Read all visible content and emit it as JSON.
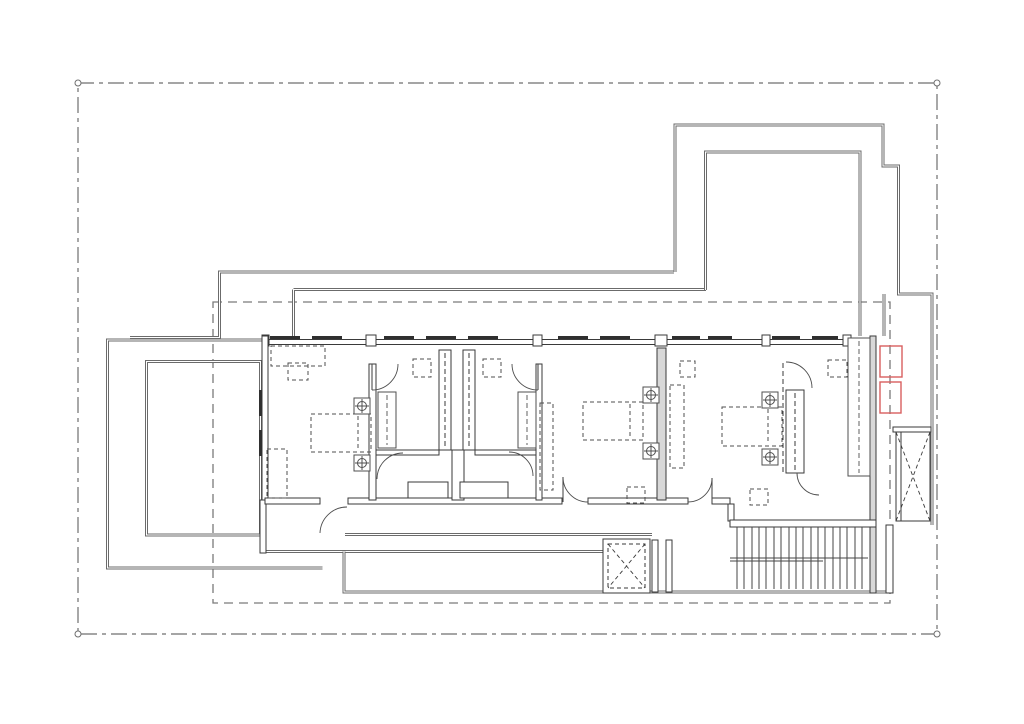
{
  "page": {
    "title": "Architectural floor plan drawing",
    "background": "#ffffff"
  },
  "colors": {
    "paper": "#ffffff",
    "boundary_line": "#6f6f6f",
    "setback_line": "#7a7a7a",
    "roof_line": "#6b6b6b",
    "wall_line": "#3a3a3a",
    "detail_line": "#4d4d4d",
    "furniture_line": "#4f4f4f",
    "stair_line": "#454545",
    "highlight_red": "#d95f5f",
    "wall_fill": "#ffffff",
    "poche_fill": "#d8d8d8",
    "tick_fill": "#2f2f2f"
  },
  "drawing": {
    "type": "architectural floor plan",
    "elements": [
      "property boundary with corner markers",
      "dashed setback outline",
      "left terrace with parapet",
      "upper terrace",
      "three bedrooms with beds and wardrobes",
      "shared bathroom core",
      "dressing partition",
      "corridor and south walkway deck",
      "staircase",
      "two crossed shafts",
      "red highlight markers"
    ],
    "counts": {
      "corner_markers": 4,
      "beds": 3,
      "bedside_lamp_symbols": 6,
      "red_highlight_markers": 2,
      "stair_treads": 17,
      "crossed_shafts": 2,
      "door_swings": 10
    }
  }
}
